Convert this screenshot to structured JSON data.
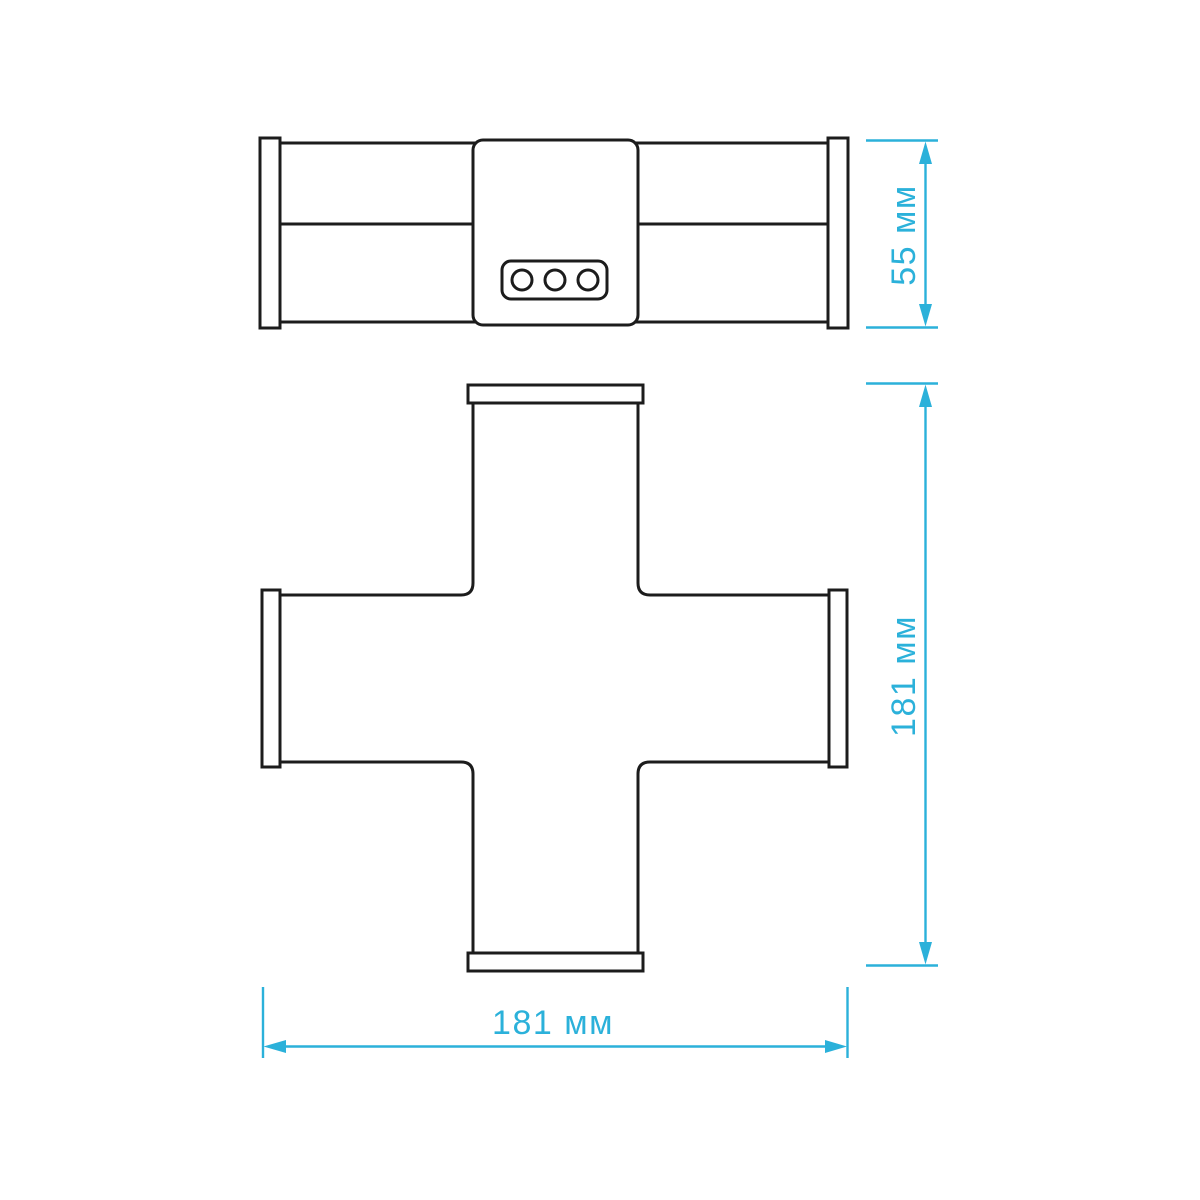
{
  "drawing": {
    "colors": {
      "accent": "#2bb1da",
      "line": "#1c1c1c",
      "background": "#ffffff"
    },
    "dimensions": {
      "side_height": "55 мм",
      "plan_height": "181 мм",
      "plan_width": "181 мм"
    }
  }
}
